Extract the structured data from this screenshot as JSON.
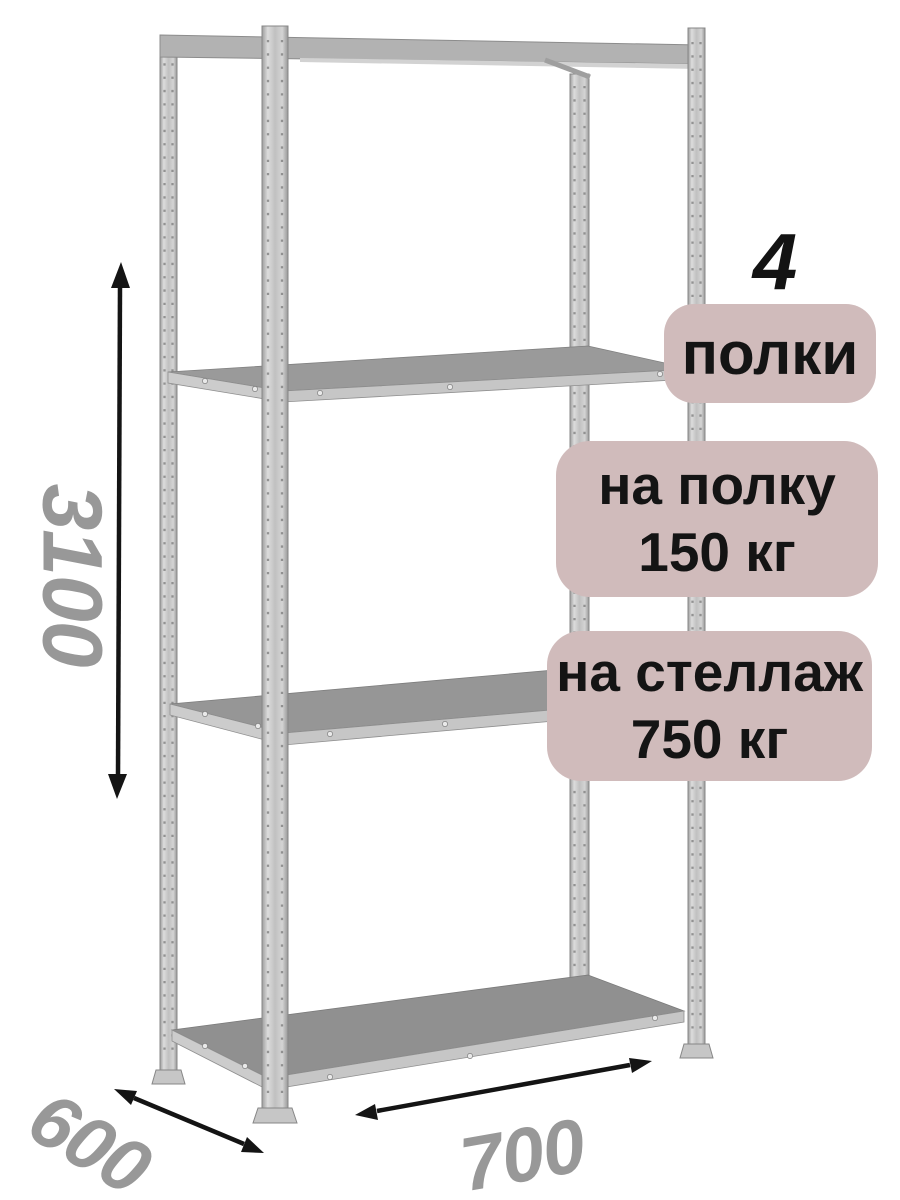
{
  "badges": {
    "count_value": "4",
    "count_label": "полки",
    "shelf_load_line1": "на полку",
    "shelf_load_line2": "150 кг",
    "rack_load_line1": "на стеллаж",
    "rack_load_line2": "750 кг"
  },
  "dimensions": {
    "height": "3100",
    "depth": "600",
    "width": "700"
  },
  "colors": {
    "background": "#ffffff",
    "badge_bg": "#d0bbbb",
    "badge_text": "#141414",
    "count_text": "#131313",
    "dimension_text": "#989898",
    "arrow": "#141414",
    "metal_light": "#dcdcdc",
    "metal_dark": "#989898",
    "shelf_surface": "#9a9a9a"
  }
}
